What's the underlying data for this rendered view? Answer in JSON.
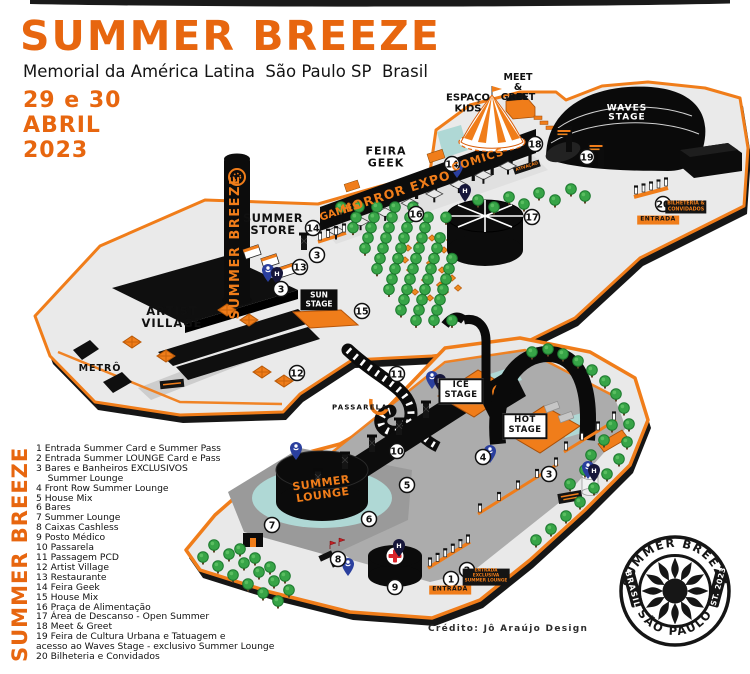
{
  "header": {
    "title": "SUMMER BREEZE",
    "subtitle": "Memorial da América Latina  São Paulo SP  Brasil",
    "date": "29 e 30\nABRIL\n2023"
  },
  "legend": {
    "vertical_title": "SUMMER BREEZE",
    "lines": [
      "1 Entrada Summer Card e Summer Pass",
      "2 Entrada Summer LOUNGE Card e Pass",
      "3 Bares e Banheiros EXCLUSIVOS",
      "    Summer Lounge",
      "4 Front Row Summer Lounge",
      "5 House Mix",
      "6 Bares",
      "7 Summer Lounge",
      "8 Caixas Cashless",
      "9 Posto Médico",
      "10 Passarela",
      "11 Passagem PCD",
      "12 Artist Village",
      "13 Restaurante",
      "14 Feira Geek",
      "15 House Mix",
      "16 Praça de Alimentação",
      "17 Área de Descanso - Open Summer",
      "18 Meet & Greet",
      "19 Feira de Cultura Urbana e Tatuagem e",
      "acesso ao Waves Stage - exclusivo Summer Lounge",
      "20 Bilheteria e Convidados"
    ]
  },
  "credit": {
    "text": "Crédito: Jô Araújo Design"
  },
  "stamp": {
    "top_arc": "SUMMER BREEZE",
    "bottom_arc": "SÃO PAULO",
    "left_banner": "BRASIL",
    "right_banner": "EST. 2023"
  },
  "map": {
    "labels": {
      "artist_village": "ARTIST\nVILLAGE",
      "metro": "METRÔ",
      "summer_store": "SUMMER\nSTORE",
      "tower": "SUMMER BREEZE",
      "feira_geek": "FEIRA\nGEEK",
      "games": "GAMES",
      "horror_expo": "HORROR EXPO",
      "comics": "COMICS",
      "espaco_kids": "ESPAÇO\nKIDS",
      "meet_greet": "MEET\n&\nGREET",
      "waves_stage": "WAVES\nSTAGE",
      "sun_stage": "SUN\nSTAGE",
      "ice_stage": "ICE\nSTAGE",
      "hot_stage": "HOT\nSTAGE",
      "summer_lounge": "SUMMER\nLOUNGE",
      "passarela": "PASSARELA",
      "entrada_1": "ENTRADA",
      "entrada_2": "ENTRADA",
      "entrada_exclusiva": "ENTRADA\nEXCLUSIVA\nSUMMER LOUNGE",
      "bilheteria": "BILHETERIA &\nCONVIDADOS",
      "ativacao": "ATIVAÇÃO"
    },
    "markers": [
      {
        "n": "14",
        "x": 313,
        "y": 228
      },
      {
        "n": "3",
        "x": 317,
        "y": 255
      },
      {
        "n": "13",
        "x": 300,
        "y": 267
      },
      {
        "n": "3",
        "x": 281,
        "y": 289
      },
      {
        "n": "15",
        "x": 362,
        "y": 311
      },
      {
        "n": "12",
        "x": 297,
        "y": 373
      },
      {
        "n": "16",
        "x": 416,
        "y": 214
      },
      {
        "n": "14",
        "x": 452,
        "y": 164
      },
      {
        "n": "17",
        "x": 532,
        "y": 217
      },
      {
        "n": "18",
        "x": 535,
        "y": 144
      },
      {
        "n": "19",
        "x": 587,
        "y": 157
      },
      {
        "n": "20",
        "x": 663,
        "y": 204
      },
      {
        "n": "11",
        "x": 397,
        "y": 374
      },
      {
        "n": "10",
        "x": 397,
        "y": 451
      },
      {
        "n": "5",
        "x": 407,
        "y": 485
      },
      {
        "n": "4",
        "x": 483,
        "y": 457
      },
      {
        "n": "3",
        "x": 549,
        "y": 474
      },
      {
        "n": "6",
        "x": 369,
        "y": 519
      },
      {
        "n": "7",
        "x": 272,
        "y": 525
      },
      {
        "n": "8",
        "x": 338,
        "y": 559
      },
      {
        "n": "9",
        "x": 395,
        "y": 587
      },
      {
        "n": "1",
        "x": 451,
        "y": 579
      },
      {
        "n": "2",
        "x": 467,
        "y": 570
      }
    ],
    "pins": [
      {
        "type": "accessibility",
        "x": 268,
        "y": 281
      },
      {
        "type": "h",
        "x": 277,
        "y": 284
      },
      {
        "type": "accessibility",
        "x": 457,
        "y": 177
      },
      {
        "type": "h",
        "x": 465,
        "y": 201
      },
      {
        "type": "accessibility",
        "x": 432,
        "y": 388
      },
      {
        "type": "h",
        "x": 440,
        "y": 391
      },
      {
        "type": "accessibility",
        "x": 296,
        "y": 459
      },
      {
        "type": "accessibility",
        "x": 490,
        "y": 462
      },
      {
        "type": "h",
        "x": 399,
        "y": 556
      },
      {
        "type": "accessibility",
        "x": 348,
        "y": 575
      },
      {
        "type": "accessibility",
        "x": 588,
        "y": 478
      },
      {
        "type": "h",
        "x": 594,
        "y": 481
      }
    ],
    "colors": {
      "orange": "#F07D1A",
      "title_orange": "#E7660F",
      "black": "#0D0D0D",
      "island": "#EAEAEA",
      "island_dark": "#ACACAC",
      "deck": "#9A9A9A",
      "tree": "#37A447",
      "pool": "#AFD8D5",
      "red_cross": "#D8232A",
      "pin_blue": "#2A3F9E",
      "pin_dark": "#16163A"
    }
  }
}
